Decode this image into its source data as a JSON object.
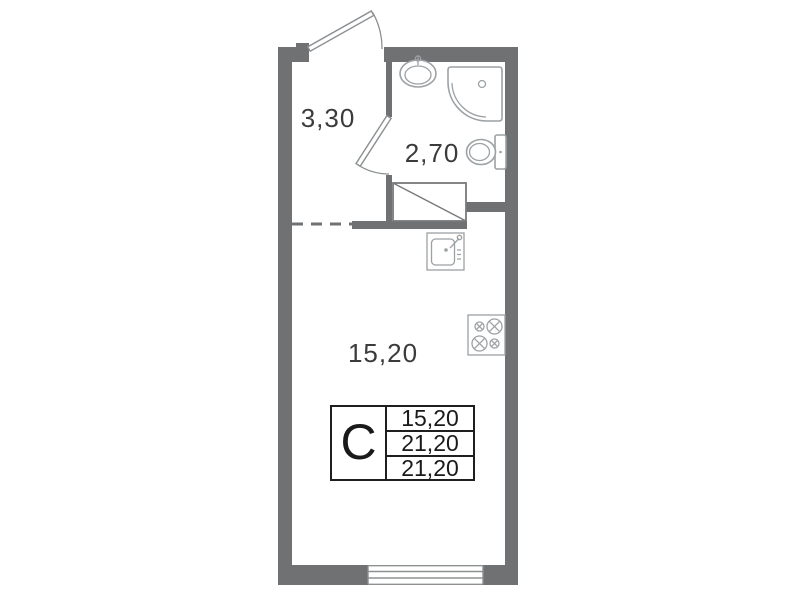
{
  "title": "Studio apartment floor plan",
  "rooms": {
    "hallway": {
      "name": "hallway",
      "area": "3,30"
    },
    "bathroom": {
      "name": "bathroom",
      "area": "2,70"
    },
    "living": {
      "name": "living-room",
      "area": "15,20"
    }
  },
  "legend": {
    "type_letter": "С",
    "rows": [
      {
        "value": "15,20"
      },
      {
        "value": "21,20"
      },
      {
        "value": "21,20"
      }
    ]
  },
  "icons": {
    "entrance-door-icon": "door-leaf-with-swing-arc",
    "bathroom-door-icon": "door-leaf-with-swing-arc",
    "bath-sink-icon": "oval-basin-with-tap",
    "shower-icon": "corner-tray-with-drain",
    "toilet-icon": "bowl-and-tank",
    "kitchen-sink-icon": "square-basin-with-tap",
    "stove-icon": "four-burner-hob",
    "window-icon": "triple-glazing-lines",
    "closet-icon": "rectangle-with-diagonal"
  },
  "colors": {
    "wall": "#6f7173",
    "fixture_line": "#9ca1a4",
    "door_line": "#8b8f91",
    "text": "#3b3b3b",
    "table_border": "#1f1f1f",
    "table_text": "#1a1a1a",
    "background": "#ffffff"
  }
}
